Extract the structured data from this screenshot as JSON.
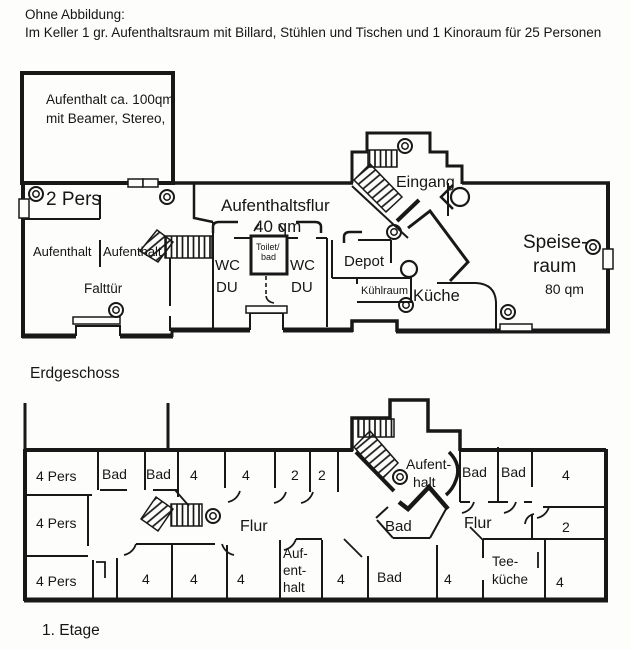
{
  "header": {
    "line1": "Ohne Abbildung:",
    "line2": "Im Keller 1 gr. Aufenthaltsraum mit Billard, Stühlen und Tischen und 1 Kinoraum für 25 Personen"
  },
  "ground_floor": {
    "caption": "Erdgeschoss",
    "rooms": {
      "big_lounge_line1": "Aufenthalt ca. 100qm",
      "big_lounge_line2": "mit Beamer, Stereo,",
      "two_pers": "2 Pers",
      "corridor_name": "Aufenthaltsflur",
      "corridor_area": "40 qm",
      "entrance": "Eingang",
      "lounge_left": "Aufenthalt",
      "lounge_right": "Aufenthalt",
      "folding_door": "Falttür",
      "wc_left_line1": "WC",
      "wc_left_line2": "DU",
      "wc_right_line1": "WC",
      "wc_right_line2": "DU",
      "toilet_line1": "Toilet/",
      "toilet_line2": "bad",
      "depot": "Depot",
      "cold_room": "Kühlraum",
      "kitchen": "Küche",
      "dining_line1": "Speise-",
      "dining_line2": "raum",
      "dining_area": "80 qm"
    }
  },
  "first_floor": {
    "caption": "1. Etage",
    "rooms": {
      "pers4_top": "4 Pers",
      "bad_top_1": "Bad",
      "bad_top_2": "Bad",
      "four_top_1": "4",
      "four_top_2": "4",
      "two_top_1": "2",
      "two_top_2": "2",
      "lounge_top_line1": "Aufent-",
      "lounge_top_line2": "halt",
      "bad_top_3": "Bad",
      "bad_top_4": "Bad",
      "four_top_3": "4",
      "pers4_mid": "4 Pers",
      "flur_left": "Flur",
      "bad_mid": "Bad",
      "flur_right": "Flur",
      "two_right": "2",
      "pers4_bottom": "4 Pers",
      "four_bottom_1": "4",
      "four_bottom_2": "4",
      "four_bottom_3": "4",
      "lounge_bottom_line1": "Auf-",
      "lounge_bottom_line2": "ent-",
      "lounge_bottom_line3": "halt",
      "four_bottom_4": "4",
      "bad_bottom": "Bad",
      "four_bottom_5": "4",
      "tea_kitchen_line1": "Tee-",
      "tea_kitchen_line2": "küche",
      "four_bottom_6": "4"
    }
  }
}
